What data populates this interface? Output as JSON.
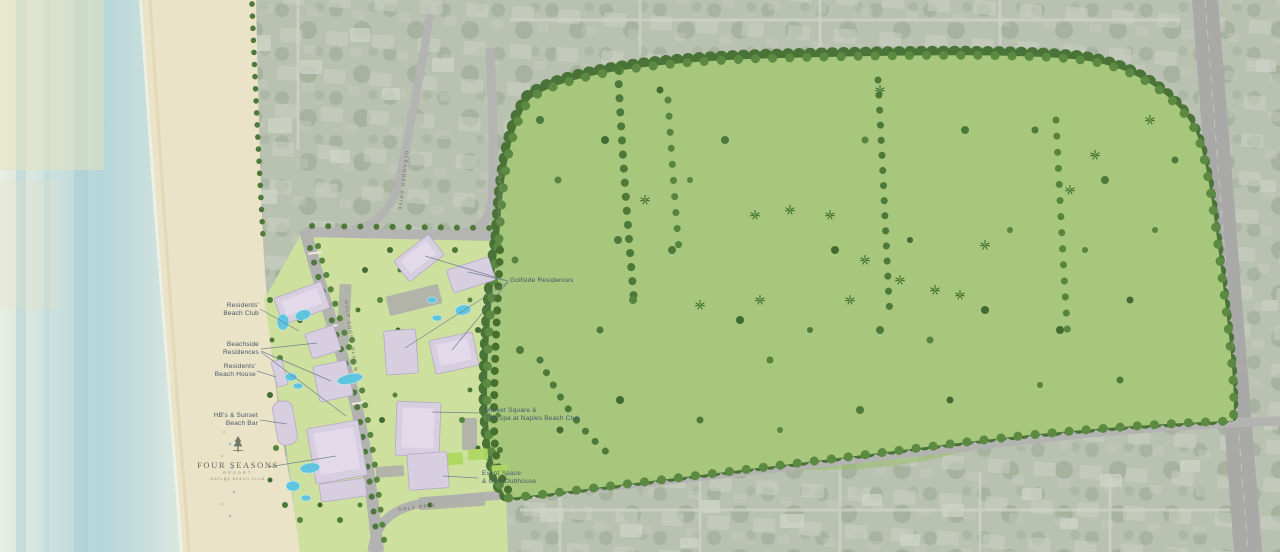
{
  "site_plan": {
    "resort_labels": {
      "residents_beach_club": {
        "line1": "Residents'",
        "line2": "Beach Club"
      },
      "beachside_residences": {
        "line1": "Beachside",
        "line2": "Residences"
      },
      "residents_beach_house": {
        "line1": "Residents'",
        "line2": "Beach House"
      },
      "hbs_sunset_beach_bar": {
        "line1": "HB's & Sunset",
        "line2": "Beach Bar"
      },
      "golfside_residences": {
        "line1": "Golfside Residences"
      },
      "market_square_spa": {
        "line1": "Market Square &",
        "line2": "The Spa at Naples Beach Club"
      },
      "event_space_golf_clubhouse": {
        "line1": "Event Space",
        "line2": "& Golf Clubhouse"
      }
    },
    "road_labels": {
      "gulf_shore_blvd": "GULF SHORE BLVD N",
      "oleander_drive": "OLEANDER DRIVE",
      "crayton_road": "CRAYTON ROAD",
      "golf_drive": "GOLF DR N"
    },
    "logo": {
      "line1": "FOUR SEASONS",
      "line2": "RESORT",
      "line3": "NAPLES BEACH CLUB",
      "icon": "four-seasons-tree-icon"
    },
    "palette": {
      "ocean": "#bcd8dc",
      "sand": "#ebe3c7",
      "aerial_background": "#b9c1b1",
      "course_turf": "#a6c77c",
      "fairway": "#c9dd94",
      "green": "#e8f1b2",
      "bunker": "#f3edca",
      "lake": "#b3dbdf",
      "tree_canopy": "#4b7438",
      "building": "#d7cee0",
      "pool": "#5fc4de",
      "road": "#b2b2b0",
      "label_text": "#44596b"
    }
  }
}
